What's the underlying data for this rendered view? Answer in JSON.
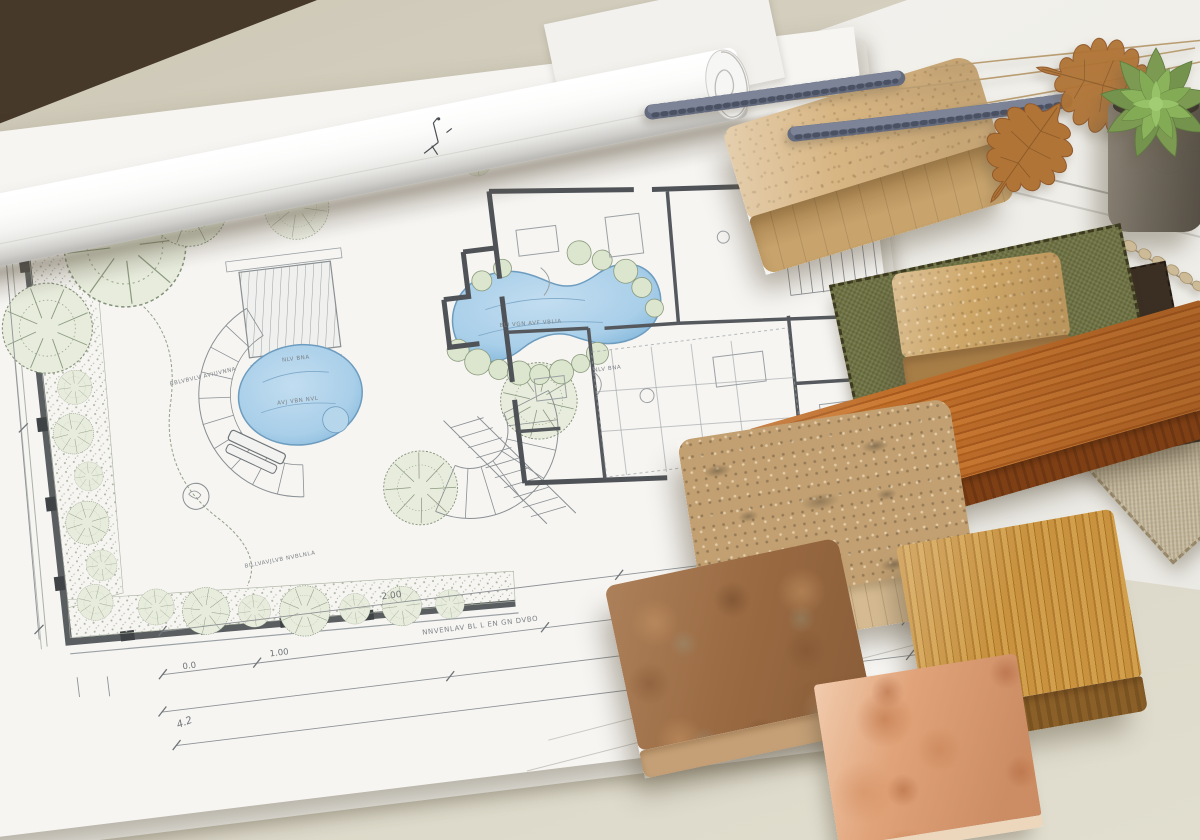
{
  "scene": {
    "desk_top": "#cdc7b6",
    "desk_bottom": "#e1decf",
    "table_edge": "#47392a",
    "paper_white": "#f6f5f2",
    "paper_under": "#e9e8e2"
  },
  "blueprint": {
    "ink": "#82878c",
    "wall": "#54585c",
    "water_fill": "#a9cfe9",
    "water_edge": "#6d9cbf",
    "foliage_fill": "#e7ecdc",
    "foliage_line": "#86937b",
    "stipple": "#aeb8a1",
    "annotations": {
      "dim_top": "2.00",
      "dim_mid": "1.00",
      "dim_left": "0.0",
      "dim_note": "4.2",
      "title_note": "NNVENLAV BL L EN GN DVBO",
      "pool_label": "BLI VGN AVF VBLIA",
      "pond_label": "AVJ VBN NVL",
      "bed_note": "BBLVBVLV AVIUVNNA",
      "patio_note": "BILLVAVJLVB NVBLNLA",
      "house_note": "NLV BNA",
      "stair_note": "0.0  5.0",
      "stair_note2": "0.00"
    }
  },
  "materials": {
    "sandstone_top": "#d8b684",
    "sandstone_front": "#c0995f",
    "paver_top": "#cda668",
    "paver_front": "#a87e47",
    "granite_top": "#c2a072",
    "granite_front": "#d6bb92",
    "cherry_face": "#bc6b26",
    "cherry_edge": "#7e3f15",
    "oak_face": "#c6923f",
    "oak_edge": "#8a5f28",
    "terracotta_face": "#9a6a42",
    "terracotta_edge": "#c5a077",
    "copper_face": "#e0a278",
    "copper_edge": "#ecd7bd",
    "olive_fabric": "#6f7342",
    "linen_fabric": "#c8bb9e",
    "dark_fabric": "#3b2f23"
  },
  "plants": {
    "pot_grey": "#6f675c",
    "succulent_green": "#7fae54",
    "succulent_dark": "#5e7b3e",
    "lavender_bud": "#646b7e",
    "lavender_stem": "#b99d72",
    "oak_leaf_brown": "#b07436",
    "willow_bud": "#cdbb98"
  }
}
